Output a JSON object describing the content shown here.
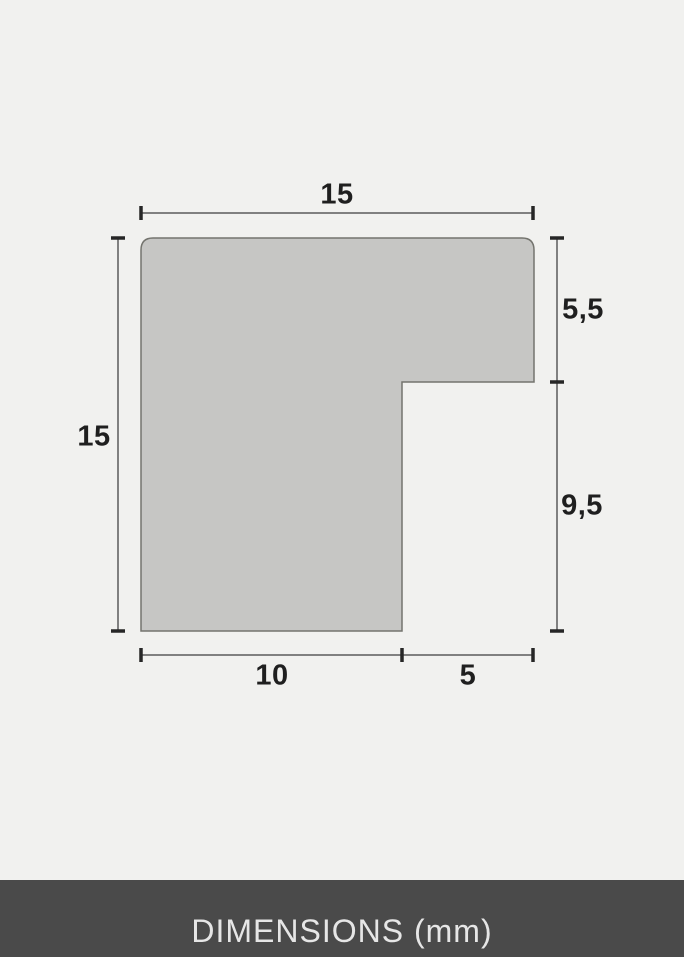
{
  "diagram": {
    "name": "frame-moulding-profile-cross-section",
    "dimensions": {
      "top_width": "15",
      "left_height": "15",
      "right_upper_height": "5,5",
      "right_lower_height": "9,5",
      "bottom_left_width": "10",
      "bottom_right_width": "5"
    },
    "colors": {
      "background": "#f1f1ef",
      "shape_fill": "#c6c6c4",
      "shape_stroke": "#74746e",
      "dimension_line": "#808080",
      "tick_mark": "#262626",
      "label_text": "#1f1f1f",
      "footer_background": "#4a4a4a",
      "footer_text": "#e6e6e6"
    }
  },
  "footer": {
    "label": "DIMENSIONS (mm)"
  }
}
